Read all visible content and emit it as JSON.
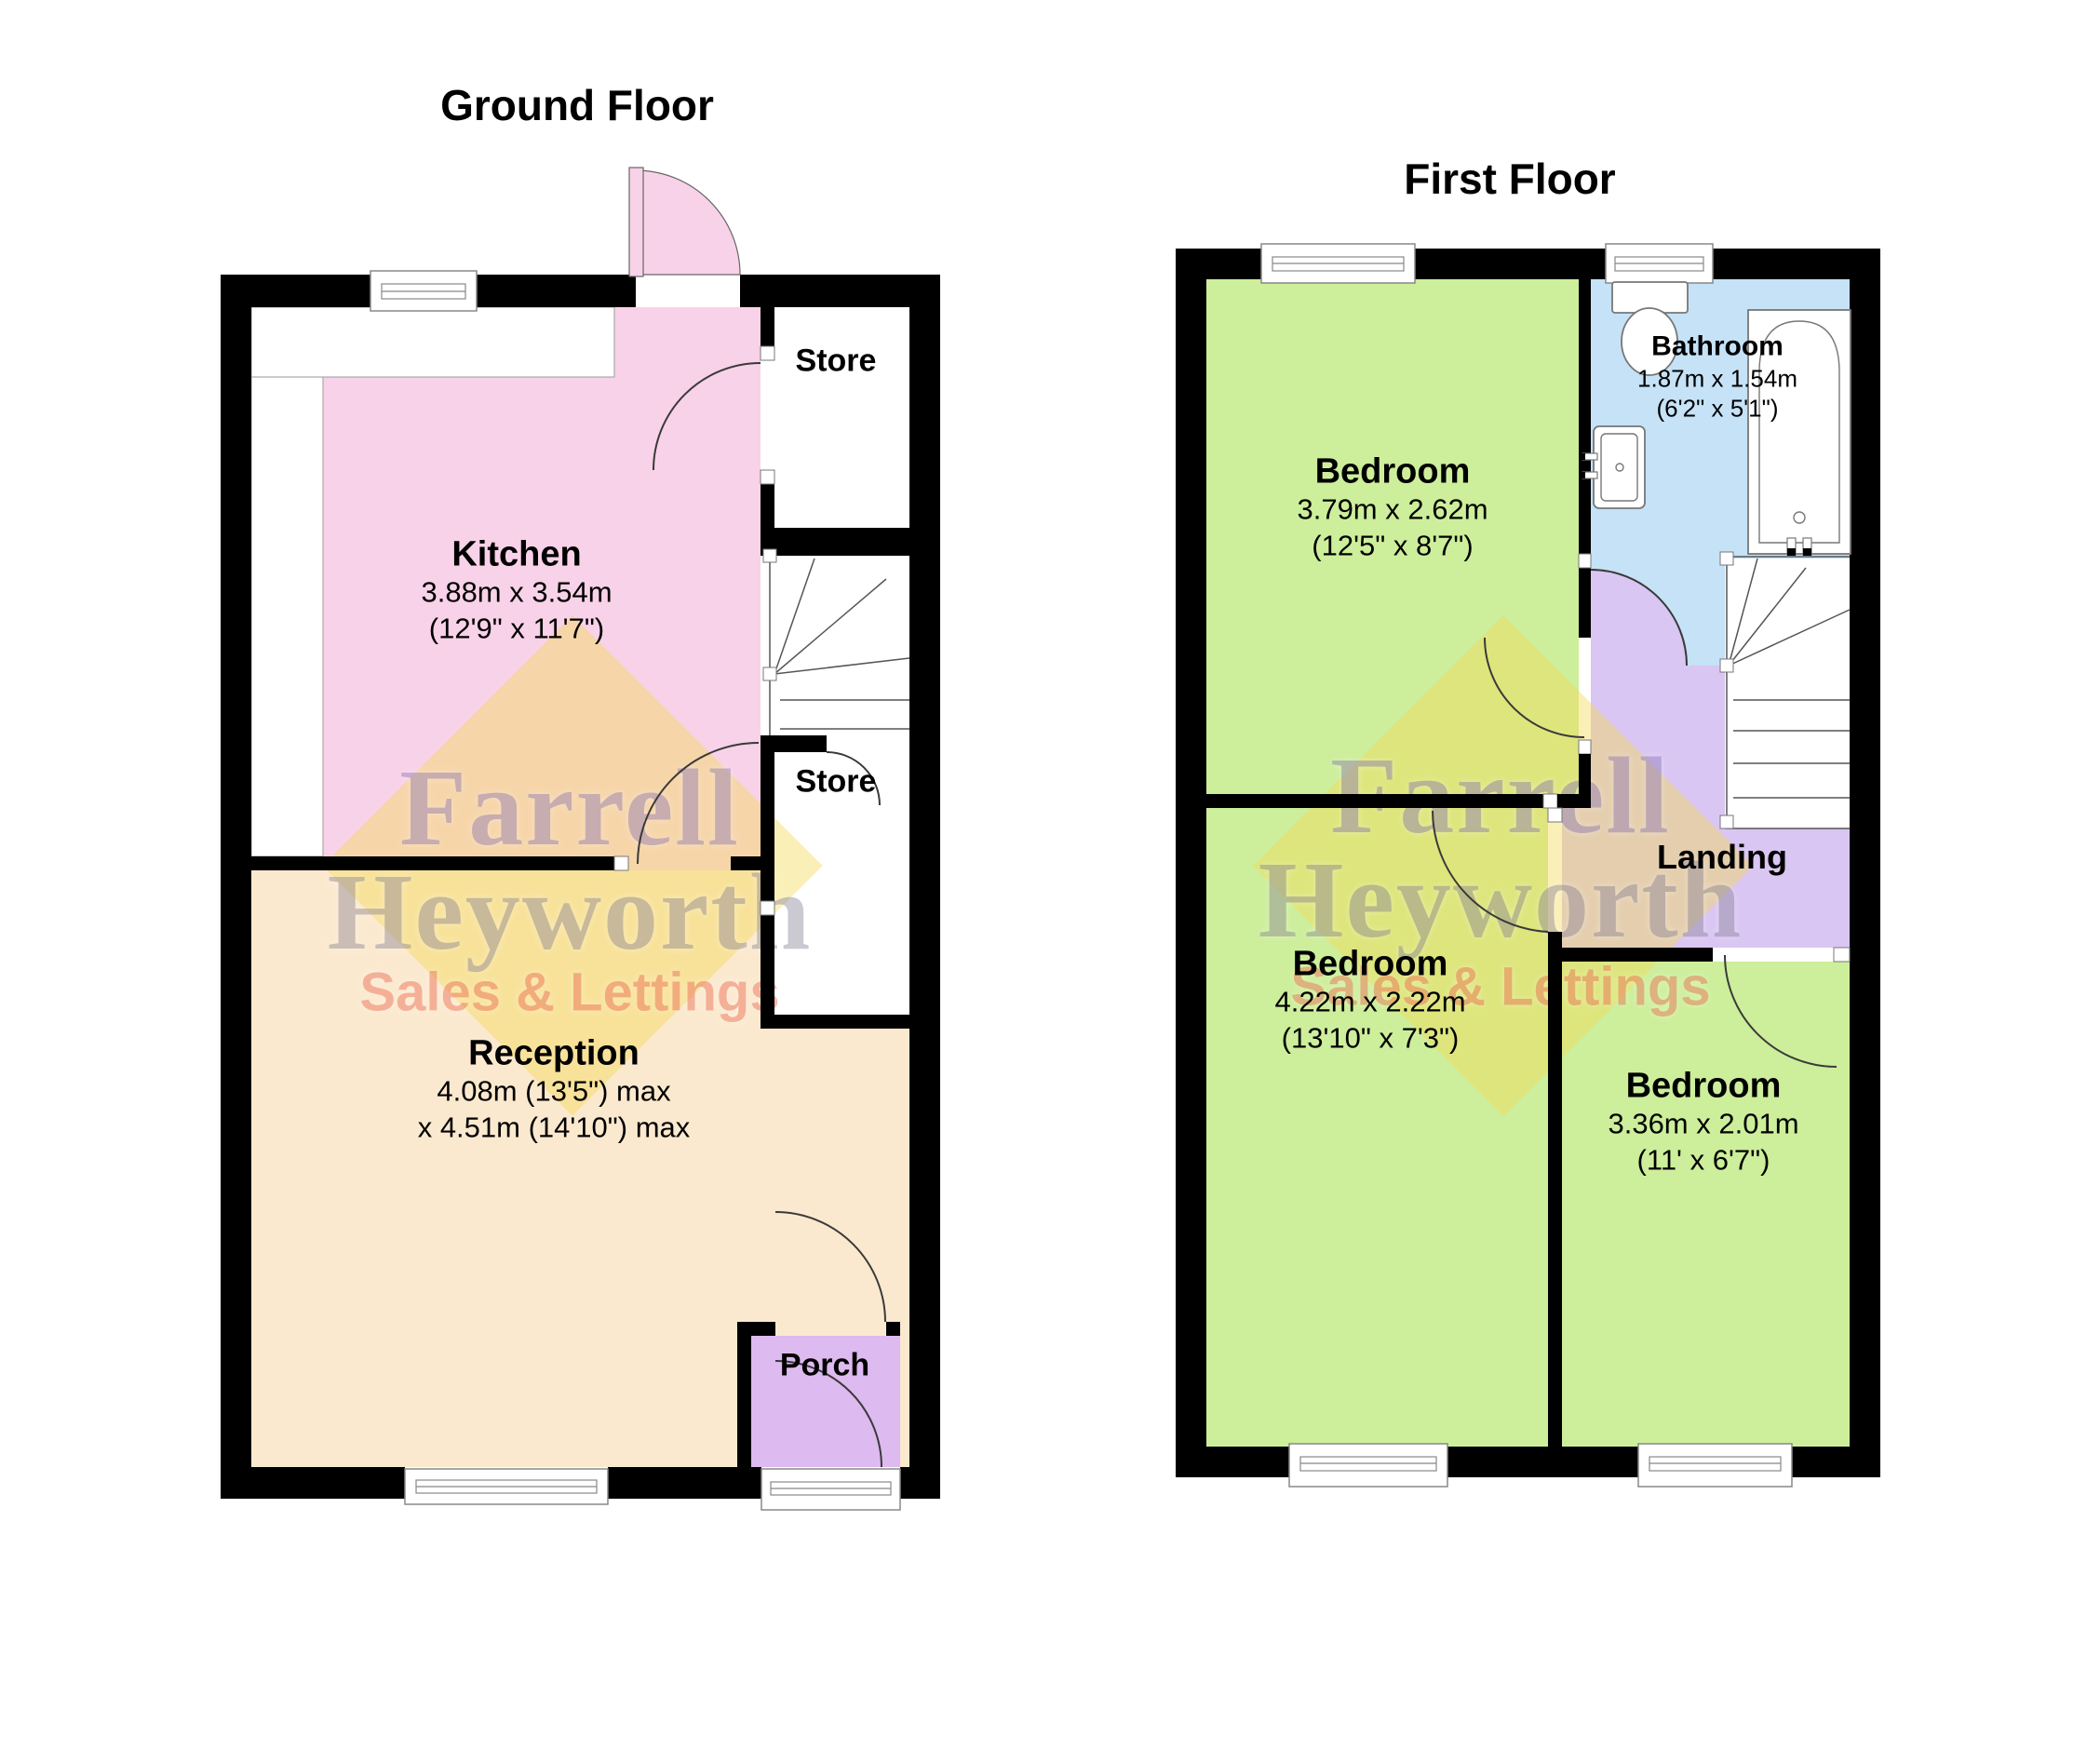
{
  "floors": [
    {
      "title": "Ground Floor",
      "rooms": [
        {
          "name": "Kitchen",
          "dim1": "3.88m x 3.54m",
          "dim2": "(12'9\" x 11'7\")"
        },
        {
          "name": "Store"
        },
        {
          "name": "Store"
        },
        {
          "name": "Reception",
          "dim1": "4.08m (13'5\") max",
          "dim2": "x 4.51m (14'10\") max"
        },
        {
          "name": "Porch"
        }
      ]
    },
    {
      "title": "First Floor",
      "rooms": [
        {
          "name": "Bedroom",
          "dim1": "3.79m x 2.62m",
          "dim2": "(12'5\" x 8'7\")"
        },
        {
          "name": "Bathroom",
          "dim1": "1.87m x 1.54m",
          "dim2": "(6'2\" x 5'1\")"
        },
        {
          "name": "Bedroom",
          "dim1": "4.22m x 2.22m",
          "dim2": "(13'10\" x 7'3\")"
        },
        {
          "name": "Bedroom",
          "dim1": "3.36m x 2.01m",
          "dim2": "(11' x 6'7\")"
        },
        {
          "name": "Landing"
        }
      ]
    }
  ],
  "watermark": {
    "line1": "Farrell",
    "line2": "Heyworth",
    "line3": "Sales & Lettings"
  },
  "colors": {
    "kitchen": "#F8D2E8",
    "reception": "#FBE9CF",
    "porch": "#DDBAF0",
    "bedroom": "#CDEE9B",
    "bathroom": "#C5E2F7",
    "landing": "#D9C6F2",
    "wall": "#000000",
    "watermarkYellow": "#F4D952",
    "watermarkPurple": "#8F7BB9",
    "watermarkSalmon": "#EE7860"
  }
}
